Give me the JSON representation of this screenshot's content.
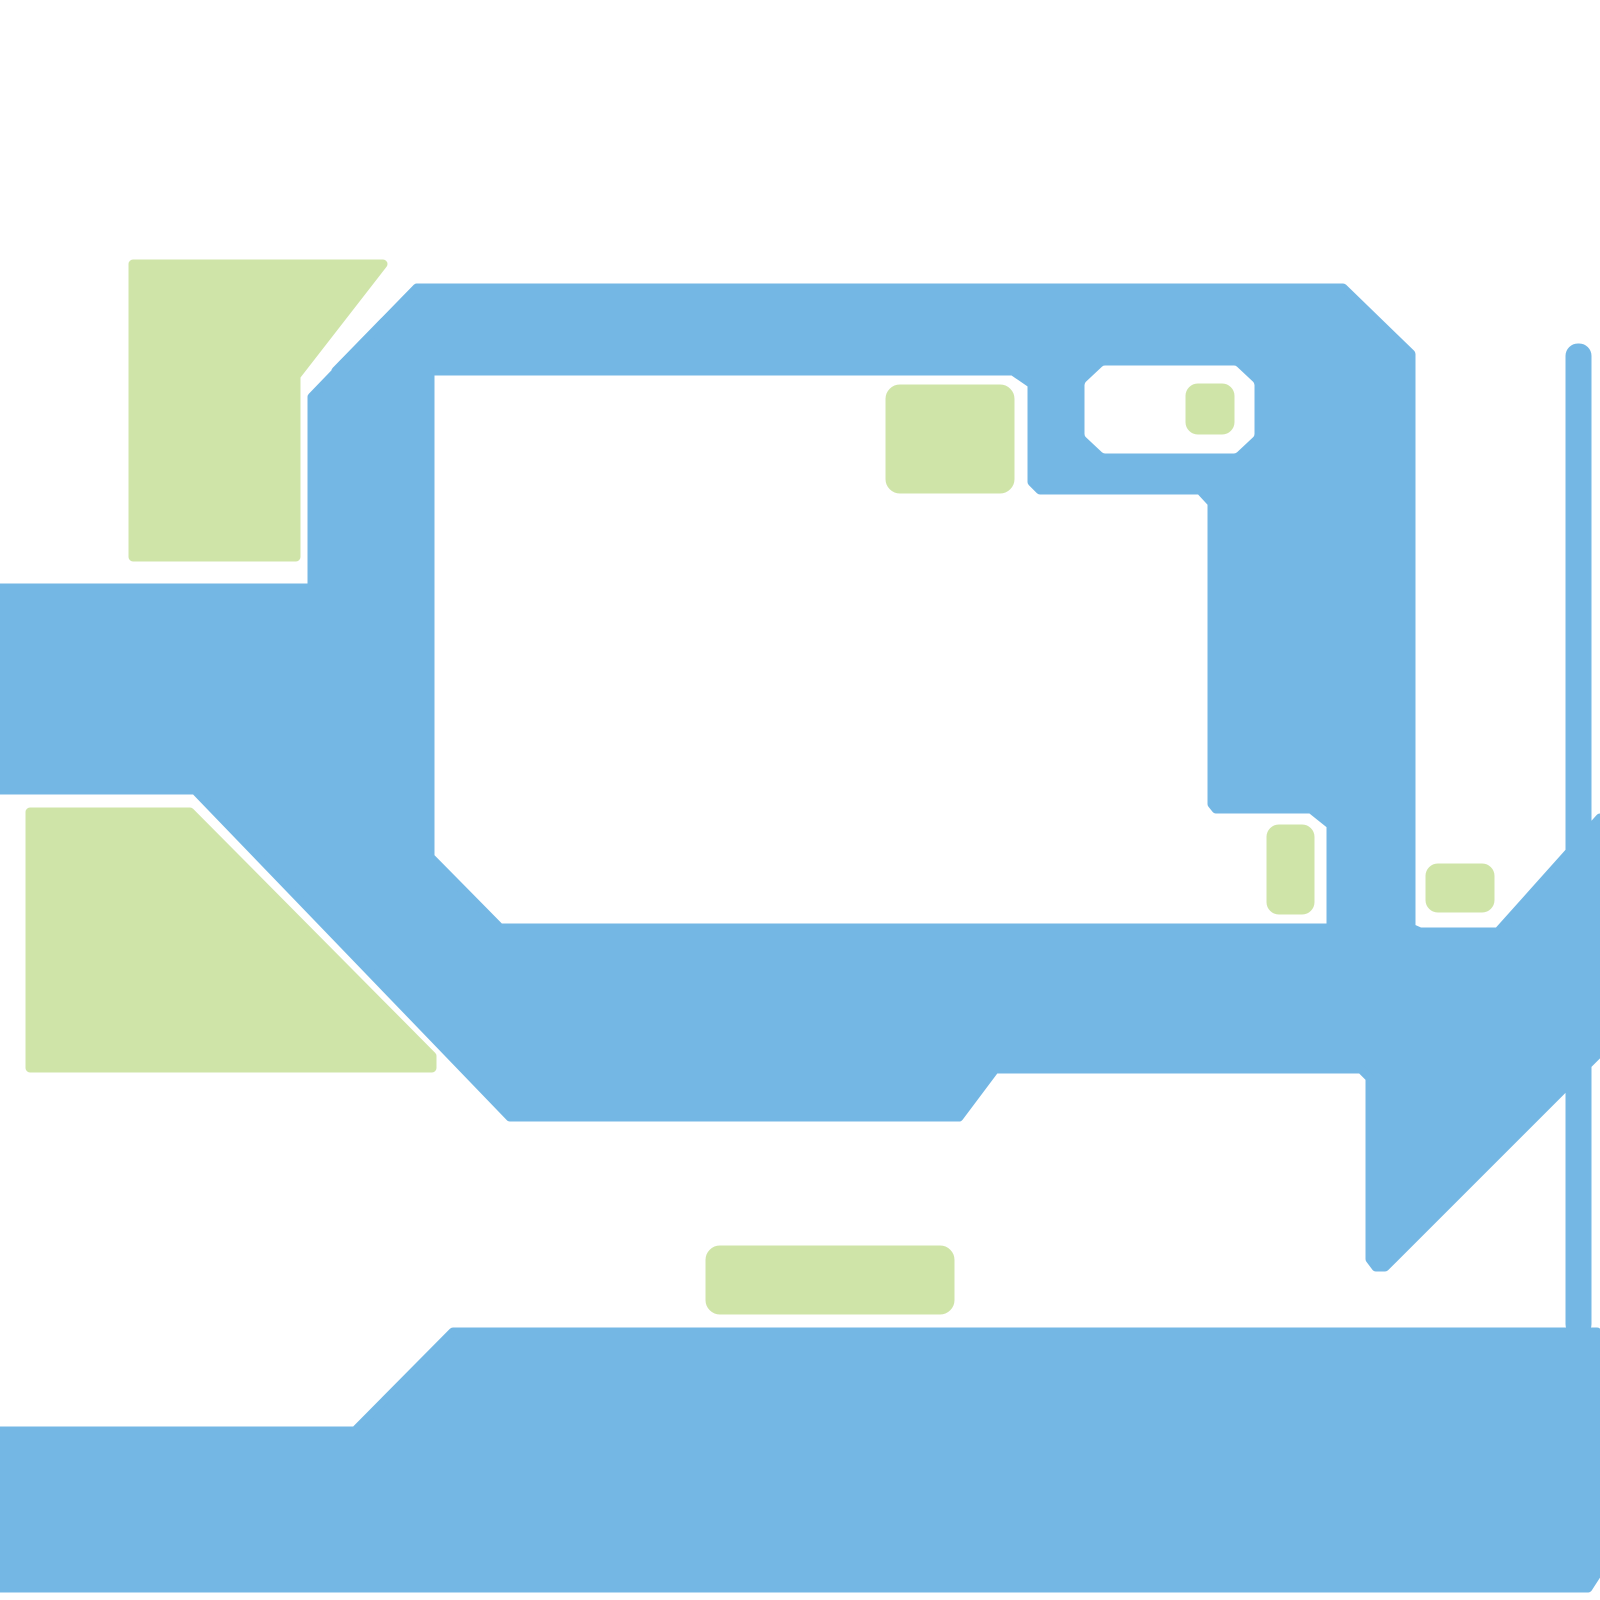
{
  "canvas": {
    "width": 1600,
    "height": 1600,
    "background_color": "#ffffff"
  },
  "palette": {
    "road_blue": "#74b7e4",
    "park_green": "#cfe4a8",
    "background_white": "#ffffff"
  },
  "shapes": [
    {
      "name": "road-top-band",
      "type": "polygon",
      "color": "road_blue",
      "points": [
        [
          417,
          288
        ],
        [
          1343,
          288
        ],
        [
          1411,
          354
        ],
        [
          1411,
          930
        ],
        [
          1331,
          930
        ],
        [
          1331,
          825
        ],
        [
          1311,
          809
        ],
        [
          1216,
          809
        ],
        [
          1212,
          804
        ],
        [
          1212,
          503
        ],
        [
          1200,
          490
        ],
        [
          1040,
          490
        ],
        [
          1032,
          482
        ],
        [
          1032,
          384
        ],
        [
          1013,
          371
        ],
        [
          336,
          371
        ]
      ]
    },
    {
      "name": "road-left-diagonal-connector",
      "type": "polygon",
      "color": "road_blue",
      "points": [
        [
          417,
          288
        ],
        [
          312,
          397
        ],
        [
          312,
          598
        ],
        [
          430,
          598
        ],
        [
          430,
          371
        ],
        [
          336,
          371
        ]
      ]
    },
    {
      "name": "road-main-network",
      "type": "polygon",
      "color": "road_blue",
      "points": [
        [
          0,
          588
        ],
        [
          430,
          588
        ],
        [
          430,
          857
        ],
        [
          500,
          928
        ],
        [
          1411,
          928
        ],
        [
          1420,
          932
        ],
        [
          1498,
          932
        ],
        [
          1600,
          818
        ],
        [
          1600,
          1052
        ],
        [
          1385,
          1267
        ],
        [
          1376,
          1267
        ],
        [
          1370,
          1259
        ],
        [
          1370,
          1078
        ],
        [
          1361,
          1069
        ],
        [
          995,
          1069
        ],
        [
          959,
          1117
        ],
        [
          510,
          1117
        ],
        [
          195,
          790
        ],
        [
          0,
          790
        ]
      ]
    },
    {
      "name": "road-thin-vertical-lane",
      "type": "rect",
      "color": "road_blue",
      "x": 1570,
      "y": 348,
      "width": 17,
      "height": 984,
      "rx": 8
    },
    {
      "name": "road-bottom-band",
      "type": "polygon",
      "color": "road_blue",
      "points": [
        [
          0,
          1431
        ],
        [
          355,
          1431
        ],
        [
          453,
          1332
        ],
        [
          1597,
          1332
        ],
        [
          1597,
          1574
        ],
        [
          1588,
          1588
        ],
        [
          0,
          1588
        ]
      ]
    },
    {
      "name": "block-octagon-cutout",
      "type": "polygon",
      "color": "background_white",
      "points": [
        [
          1089,
          385
        ],
        [
          1105,
          370
        ],
        [
          1234,
          370
        ],
        [
          1250,
          385
        ],
        [
          1250,
          434
        ],
        [
          1234,
          449
        ],
        [
          1105,
          449
        ],
        [
          1089,
          434
        ]
      ]
    },
    {
      "name": "park-top-left",
      "type": "polygon",
      "color": "park_green",
      "points": [
        [
          133,
          264
        ],
        [
          383,
          264
        ],
        [
          296,
          376
        ],
        [
          296,
          557
        ],
        [
          133,
          557
        ]
      ]
    },
    {
      "name": "park-bottom-left",
      "type": "polygon",
      "color": "park_green",
      "points": [
        [
          30,
          812
        ],
        [
          190,
          812
        ],
        [
          432,
          1056
        ],
        [
          432,
          1068
        ],
        [
          30,
          1068
        ]
      ]
    },
    {
      "name": "park-square-in-block",
      "type": "rect",
      "color": "park_green",
      "x": 890,
      "y": 389,
      "width": 120,
      "height": 100,
      "rx": 10
    },
    {
      "name": "park-dot-in-octagon",
      "type": "rect",
      "color": "park_green",
      "x": 1190,
      "y": 388,
      "width": 40,
      "height": 42,
      "rx": 8
    },
    {
      "name": "park-small-vertical",
      "type": "rect",
      "color": "park_green",
      "x": 1271,
      "y": 829,
      "width": 39,
      "height": 81,
      "rx": 8
    },
    {
      "name": "park-small-horizontal",
      "type": "rect",
      "color": "park_green",
      "x": 1430,
      "y": 868,
      "width": 60,
      "height": 40,
      "rx": 8
    },
    {
      "name": "park-bottom-pill",
      "type": "rect",
      "color": "park_green",
      "x": 710,
      "y": 1250,
      "width": 240,
      "height": 60,
      "rx": 10
    }
  ]
}
